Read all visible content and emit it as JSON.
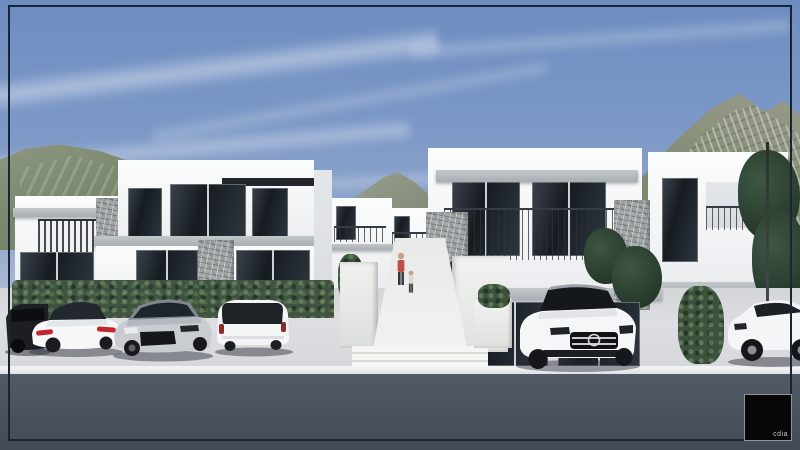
{
  "title": "Architectural exterior rendering of modern two-storey white villas",
  "logo": {
    "text": "cdia"
  },
  "palette": {
    "sky_top": "#6d8cc0",
    "sky_horizon": "#d3d8e0",
    "frame_border": "#1b2433",
    "wall_white": "#f4f5f6",
    "glass_dark": "#1d2329",
    "stone_grey": "#a3a8aa",
    "hedge_green": "#3f5340",
    "tree_green": "#263a2b",
    "pavement_grey": "#d8dade",
    "road_asphalt": "#49505e",
    "taillight_red": "#c4262e",
    "logo_bg": "#060607"
  },
  "scene": {
    "sky": "blue sky with wispy cirrus clouds",
    "mountains": [
      "green hills on the left",
      "distant peak between buildings",
      "rocky vegetated mountain on the right"
    ],
    "buildings": [
      "left two-storey white villa block with stone accents and slat balcony",
      "background villas along central path",
      "right two-storey white villa block with long railed balcony and stone accents"
    ],
    "people": [
      "adult in red top walking up central path",
      "child walking on central path"
    ],
    "cars": [
      {
        "name": "dark SUV at left edge",
        "color": "black",
        "view": "rear"
      },
      {
        "name": "white sedan with red taillights",
        "color": "white",
        "view": "rear three-quarter"
      },
      {
        "name": "silver hatchback",
        "color": "silver",
        "view": "front three-quarter"
      },
      {
        "name": "white compact hatchback",
        "color": "white",
        "view": "rear"
      },
      {
        "name": "white luxury SUV",
        "color": "white",
        "view": "front three-quarter"
      },
      {
        "name": "white sports SUV at right edge",
        "color": "white",
        "view": "side"
      }
    ],
    "ground": [
      "light concrete parking apron",
      "white curb line",
      "dark asphalt road"
    ]
  }
}
